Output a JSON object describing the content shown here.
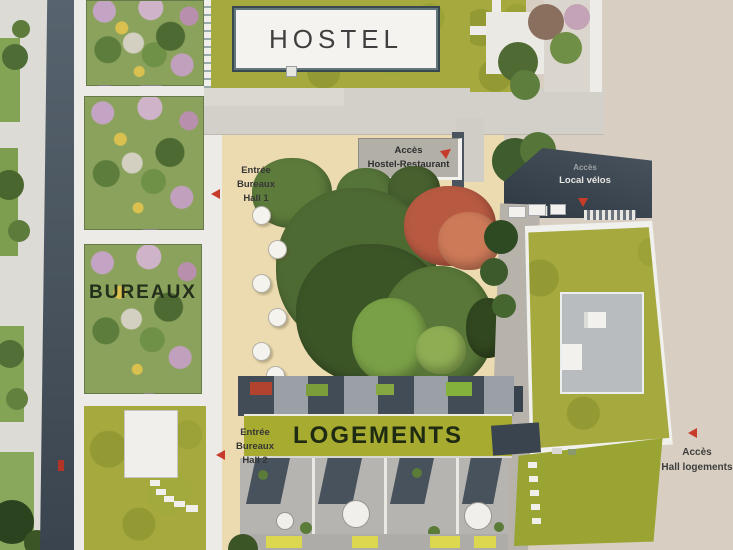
{
  "scene": {
    "description": "Aerial 3D site plan of a mixed-use block",
    "width": 733,
    "height": 550
  },
  "buildings": {
    "hostel": {
      "label": "HOSTEL"
    },
    "bureaux": {
      "label": "BUREAUX"
    },
    "logements": {
      "label": "LOGEMENTS"
    }
  },
  "annotations": {
    "acces_hostel_restaurant": {
      "line1": "Accès",
      "line2": "Hostel-Restaurant",
      "arrow": "up-right"
    },
    "entree_bureaux_hall1": {
      "line1": "Entrée",
      "line2": "Bureaux",
      "line3": "Hall 1",
      "arrow": "left"
    },
    "entree_bureaux_hall2": {
      "line1": "Entrée",
      "line2": "Bureaux",
      "line3": "Hall 2",
      "arrow": "left"
    },
    "acces_local_velos": {
      "line1": "Accès",
      "line2": "Local vélos",
      "arrow": "down"
    },
    "acces_hall_logements": {
      "line1": "Accès",
      "line2": "Hall logements",
      "arrow": "left"
    }
  },
  "colors": {
    "arrow_red": "#c63b2a",
    "green_roof": "#a5a93e",
    "logements_strip_green": "#a7ab2f",
    "plaza_beige": "#ecdbb0",
    "street_beige": "#d8cfc2",
    "street_gray": "#dddbd6",
    "dark_roof_slate": "#3f4a54",
    "building_white": "#edebe7",
    "label_text": "#363636"
  }
}
